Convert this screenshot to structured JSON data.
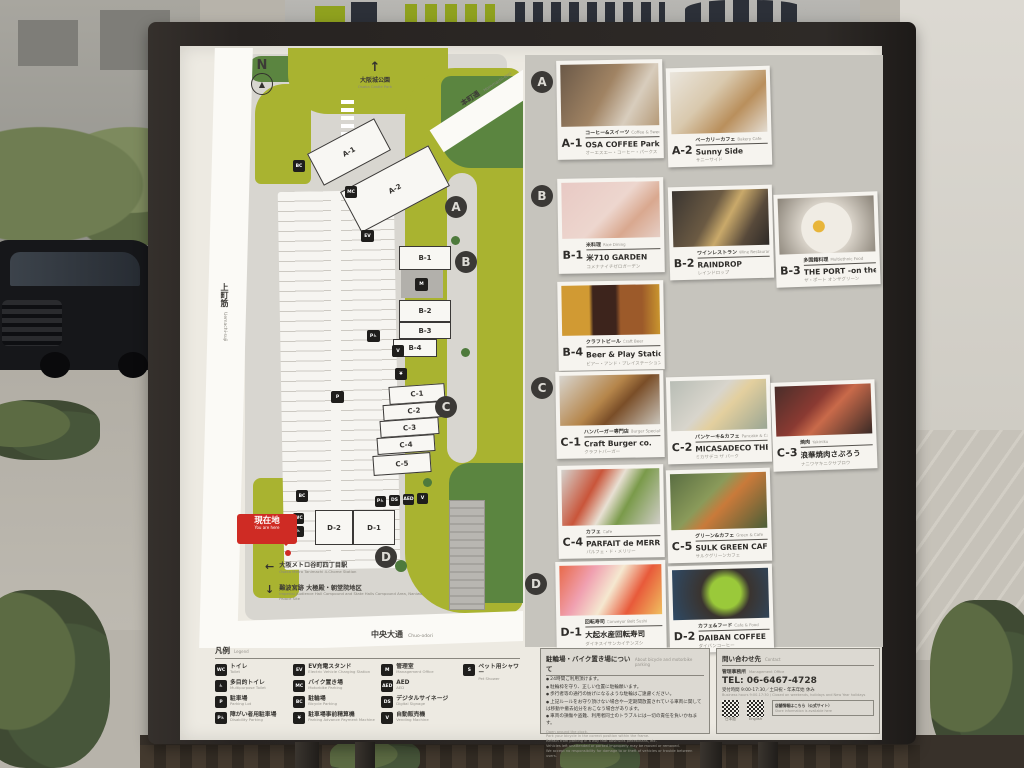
{
  "map": {
    "compass_label": "N",
    "north_poi": {
      "jp": "大阪城公園",
      "en": "Osaka Castle Park"
    },
    "road_top": {
      "jp": "本町通",
      "en": "Hommachi-dori"
    },
    "road_left": {
      "jp": "上町筋",
      "en": "Uemachi-suji"
    },
    "road_bottom": {
      "jp": "中央大通",
      "en": "Chuo-odori"
    },
    "you_are_here": {
      "jp": "現在地",
      "en": "You are here"
    },
    "badges": {
      "a": "A",
      "b": "B",
      "c": "C",
      "d": "D"
    },
    "buildings": {
      "a1": "A-1",
      "a2": "A-2",
      "b1": "B-1",
      "b2": "B-2",
      "b3": "B-3",
      "b4": "B-4",
      "c1": "C-1",
      "c2": "C-2",
      "c3": "C-3",
      "c4": "C-4",
      "c5": "C-5",
      "d1": "D-1",
      "d2": "D-2"
    },
    "directions": [
      {
        "arrow": "←",
        "jp": "大阪メトロ谷町四丁目駅",
        "en": "Osaka Metro Tanimachi 4-Chome Station"
      },
      {
        "arrow": "↓",
        "jp": "難波宮跡 大極殿・朝堂院地区",
        "en": "Imperial Audience Hall Compound and State Halls Compound Area, Naniwa Palace Site"
      }
    ],
    "icon_glyphs": {
      "bicycle": "BC",
      "motorbike": "MC",
      "ev": "EV",
      "disability": "P♿",
      "payment": "¥",
      "parking": "P",
      "management": "M",
      "toilet": "WC",
      "multipurpose": "♿",
      "vending": "V",
      "signage": "DS",
      "aed": "AED"
    }
  },
  "directory": {
    "shops": [
      {
        "id": "A-1",
        "cat_jp": "コーヒー&スイーツ",
        "cat_en": "Coffee & Sweets",
        "name": "OSA COFFEE Parks",
        "reading": "オーエスエー・コーヒー・パークス"
      },
      {
        "id": "A-2",
        "cat_jp": "ベーカリーカフェ",
        "cat_en": "Bakery Cafe",
        "name": "Sunny Side",
        "reading": "サニーサイド"
      },
      {
        "id": "B-1",
        "cat_jp": "米料理",
        "cat_en": "Rice Dining",
        "name": "米710 GARDEN",
        "reading": "コメナナイチゼロガーデン"
      },
      {
        "id": "B-2",
        "cat_jp": "ワインレストラン",
        "cat_en": "Wine Restaurant",
        "name": "RAINDROP",
        "reading": "レインドロップ"
      },
      {
        "id": "B-3",
        "cat_jp": "多国籍料理",
        "cat_en": "Multiethnic Food",
        "name": "THE PORT -on the Green-",
        "reading": "ザ・ポート オンザグリーン"
      },
      {
        "id": "B-4",
        "cat_jp": "クラフトビール",
        "cat_en": "Craft Beer",
        "name": "Beer & Play Station ちるちる",
        "reading": "ビアー・アンド・プレイステーション・チルチル"
      },
      {
        "id": "C-1",
        "cat_jp": "ハンバーガー専門店",
        "cat_en": "Burger Specialty Store",
        "name": "Craft Burger co.",
        "reading": "クラフトバーガー"
      },
      {
        "id": "C-2",
        "cat_jp": "パンケーキ&カフェ",
        "cat_en": "Pancake & Cafe",
        "name": "MICASADECO THE PARK",
        "reading": "ミカサデコ ザ パーク"
      },
      {
        "id": "C-3",
        "cat_jp": "焼肉",
        "cat_en": "Yakiniku",
        "name": "浪華焼肉さぶろう",
        "reading": "ナニワヤキニクサブロウ"
      },
      {
        "id": "C-4",
        "cat_jp": "カフェ",
        "cat_en": "Cafe",
        "name": "PARFAIT de MERRILY",
        "reading": "パルフェ・ド・メリリー"
      },
      {
        "id": "C-5",
        "cat_jp": "グリーン&カフェ",
        "cat_en": "Green & Cafe",
        "name": "SULK GREEN CAFE",
        "reading": "サルクグリーンカフェ"
      },
      {
        "id": "D-1",
        "cat_jp": "回転寿司",
        "cat_en": "Conveyor Belt Sushi",
        "name": "大起水産回転寿司",
        "reading": "ダイキスイサンカイテンズシ"
      },
      {
        "id": "D-2",
        "cat_jp": "カフェ&フード",
        "cat_en": "Cafe & Food",
        "name": "DAIBAN COFFEE",
        "reading": "ダイバンコーヒー"
      }
    ]
  },
  "legend": {
    "title_jp": "凡例",
    "title_en": "Legend",
    "items": [
      {
        "glyph": "WC",
        "jp": "トイレ",
        "en": "Toilet"
      },
      {
        "glyph": "♿",
        "jp": "多目的トイレ",
        "en": "Multipurpose Toilet"
      },
      {
        "glyph": "P",
        "jp": "駐車場",
        "en": "Parking Lot"
      },
      {
        "glyph": "P♿",
        "jp": "障がい者用駐車場",
        "en": "Disability Parking"
      },
      {
        "glyph": "EV",
        "jp": "EV充電スタンド",
        "en": "Electric Vehicle Charging Station"
      },
      {
        "glyph": "MC",
        "jp": "バイク置き場",
        "en": "Motorbike Parking"
      },
      {
        "glyph": "BC",
        "jp": "駐輪場",
        "en": "Bicycle Parking"
      },
      {
        "glyph": "¥",
        "jp": "駐車場事前精算機",
        "en": "Parking Advance Payment Machine"
      },
      {
        "glyph": "M",
        "jp": "管理室",
        "en": "Management Office"
      },
      {
        "glyph": "AED",
        "jp": "AED",
        "en": "AED"
      },
      {
        "glyph": "DS",
        "jp": "デジタルサイネージ",
        "en": "Digital Signage"
      },
      {
        "glyph": "V",
        "jp": "自動販売機",
        "en": "Vending Machine"
      },
      {
        "glyph": "S",
        "jp": "ペット用シャワー",
        "en": "Pet Shower"
      }
    ]
  },
  "parking_notice": {
    "title_jp": "駐輪場・バイク置き場について",
    "title_en": "About bicycle and motorbike parking",
    "bullets_jp": [
      "24時間ご利用頂けます。",
      "駐輪枠を守り、正しい位置に駐輪願います。",
      "歩行者等の通行の妨げになるような駐輪はご遠慮ください。",
      "上記ルールをお守り頂けない場合や一定期間放置されている車両に関しては移動や撤去処分をおこなう場合があります。",
      "車両の損傷や盗難、利用者同士のトラブルには一切の責任を負いかねます。"
    ],
    "notes_en": [
      "Open around the clock.",
      "Park your bicycle in the correct position within the frame.",
      "Refrain from parking in a way that obstructs pedestrians, etc.",
      "Vehicles left unattended or parked improperly may be moved or removed.",
      "We accept no responsibility for damage to or theft of vehicles or trouble between users."
    ]
  },
  "contact": {
    "title_jp": "問い合わせ先",
    "title_en": "Contact",
    "office_jp": "管理事務所",
    "office_en": "Management Office",
    "tel": "TEL: 06-6467-4728",
    "hours_jp": "受付時間 9:00-17:30／土日祝・年末年始 休み",
    "hours_en": "Business hours 9:00-17:30 / Closed on weekends, holidays and New Year holidays",
    "qr1_label": "日本語",
    "qr2_label": "English",
    "note_jp": "店舗情報はこちら（公式サイト）",
    "note_en": "Store information is available here"
  }
}
